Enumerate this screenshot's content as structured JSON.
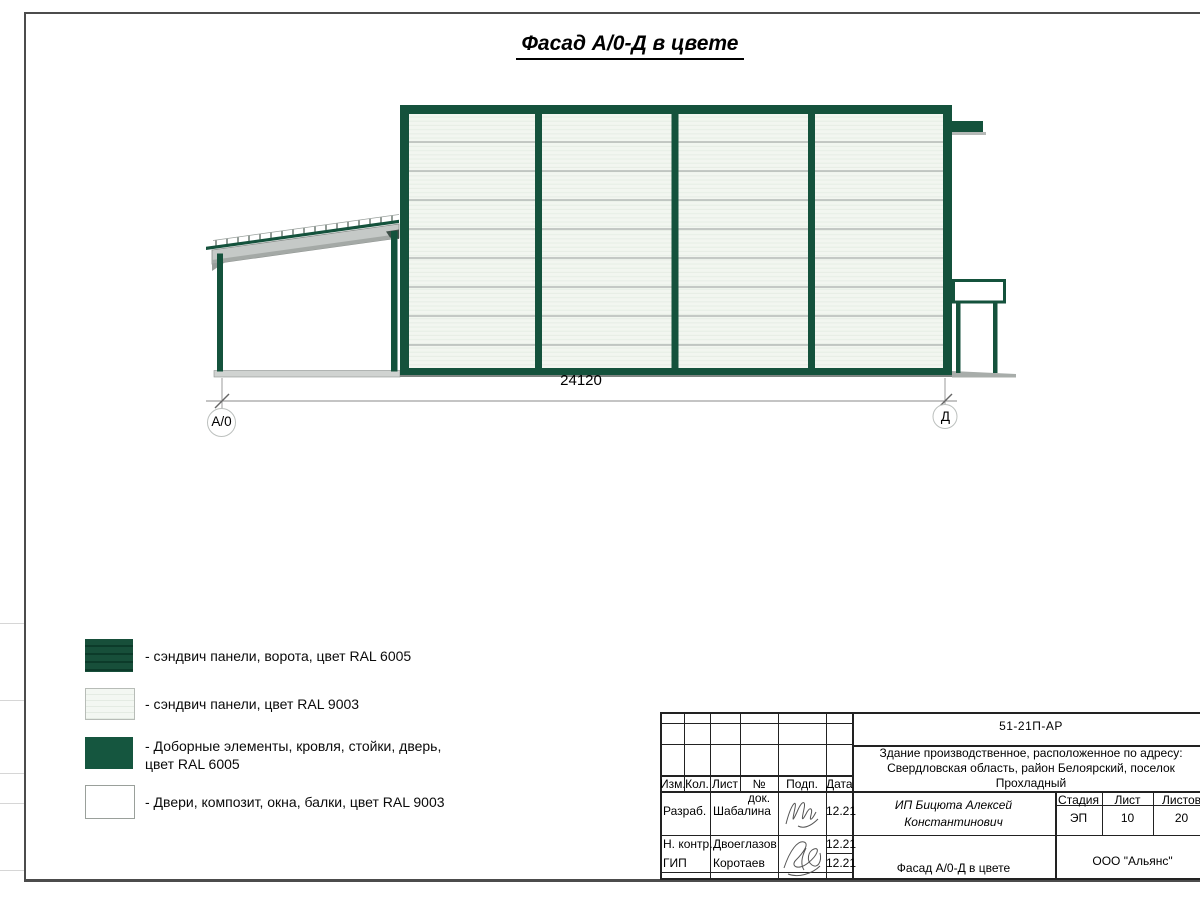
{
  "page": {
    "title": "Фасад А/0-Д в цвете"
  },
  "drawing": {
    "dimension": "24120",
    "axis_left": "А/0",
    "axis_right": "Д"
  },
  "colors": {
    "ral6005": "#14523c",
    "ral6005_dark_stripe": "#0c3b2a",
    "ral9003": "#f2f6f0",
    "panel_divider": "#a9aeab",
    "base_grey": "#7e8481"
  },
  "legend": {
    "items": [
      {
        "swatch": "sandwich-gate-ral6005",
        "line1": "- сэндвич панели, ворота, цвет RAL 6005",
        "line2": ""
      },
      {
        "swatch": "sandwich-ral9003",
        "line1": "- сэндвич панели, цвет RAL 9003",
        "line2": ""
      },
      {
        "swatch": "trim-ral6005",
        "line1": "- Доборные элементы, кровля, стойки, дверь,",
        "line2": "цвет RAL 6005"
      },
      {
        "swatch": "doors-ral9003",
        "line1": "- Двери, композит, окна, балки, цвет RAL 9003",
        "line2": ""
      }
    ]
  },
  "title_block": {
    "doc_number": "51-21П-АР",
    "address_line1": "Здание производственное, расположенное по адресу:",
    "address_line2": "Свердловская область, район Белоярский, поселок",
    "address_line3": "Прохладный",
    "cols": {
      "izm": "Изм.",
      "kol": "Кол.",
      "list": "Лист",
      "dok": "№ док.",
      "podp": "Подп.",
      "data": "Дата"
    },
    "rows": [
      {
        "role": "Разраб.",
        "name": "Шабалина",
        "date": "12.21"
      },
      {
        "role": "Н. контр.",
        "name": "Двоеглазов",
        "date": "12.21"
      },
      {
        "role": "ГИП",
        "name": "Коротаев",
        "date": "12.21"
      }
    ],
    "customer_line1": "ИП Бицюта Алексей",
    "customer_line2": "Константинович",
    "stage_label": "Стадия",
    "sheet_label": "Лист",
    "sheets_label": "Листов",
    "stage": "ЭП",
    "sheet": "10",
    "sheets": "20",
    "drawing_title": "Фасад А/0-Д в цвете",
    "org": "ООО \"Альянс\""
  }
}
